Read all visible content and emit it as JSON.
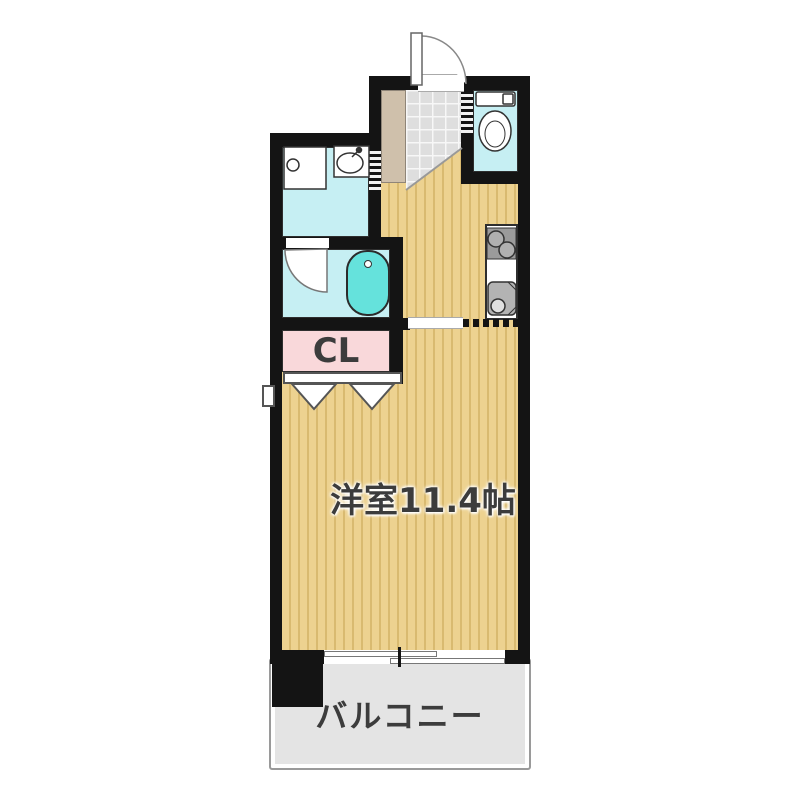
{
  "plan": {
    "labels": {
      "western_room": "洋室11.4帖",
      "closet": "CL",
      "balcony": "バルコニー"
    },
    "fixtures": [
      "entrance-door",
      "shoe-cabinet",
      "entrance-tile",
      "toilet",
      "washbasin",
      "washing-machine-pan",
      "bathtub",
      "bathroom-door",
      "washroom-sliding-door",
      "toilet-sliding-door",
      "kitchen-stove",
      "kitchen-sink",
      "closet-bifold-door",
      "sliding-window",
      "meter-box",
      "pillar"
    ],
    "colors": {
      "wall": "#141414",
      "floor-base": "#edd290",
      "floor-stripe": "#d9ba70",
      "water-room": "#c6eff3",
      "bathtub": "#65e2dc",
      "closet-pink": "#f9d8da",
      "balcony-gray": "#e4e4e4",
      "tile-gray": "#dedede",
      "cabinet-tan": "#cfc0ab",
      "label-text": "#3c3c3c"
    }
  }
}
